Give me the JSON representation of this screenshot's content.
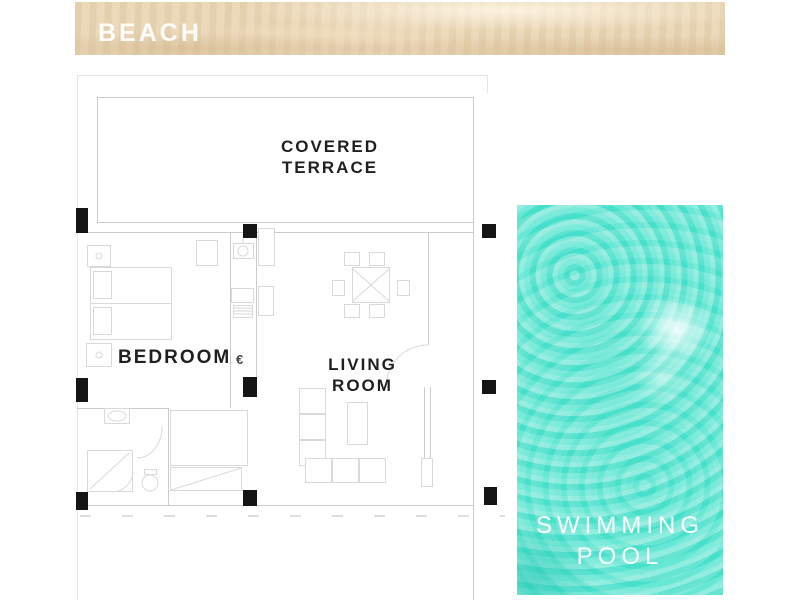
{
  "beach": {
    "label": "BEACH"
  },
  "plan": {
    "terrace_label_line1": "COVERED",
    "terrace_label_line2": "TERRACE",
    "bedroom_label": "BEDROOM",
    "living_label_line1": "LIVING",
    "living_label_line2": "ROOM",
    "electric_symbol": "€"
  },
  "pool": {
    "label_line1": "SWIMMING",
    "label_line2": "POOL"
  },
  "colors": {
    "sand": "#e9d6b6",
    "water": "#4be0ca",
    "wall": "#cccccc",
    "furn": "#d9d9d9",
    "pillar": "#141414",
    "label": "#1f1f1f"
  }
}
